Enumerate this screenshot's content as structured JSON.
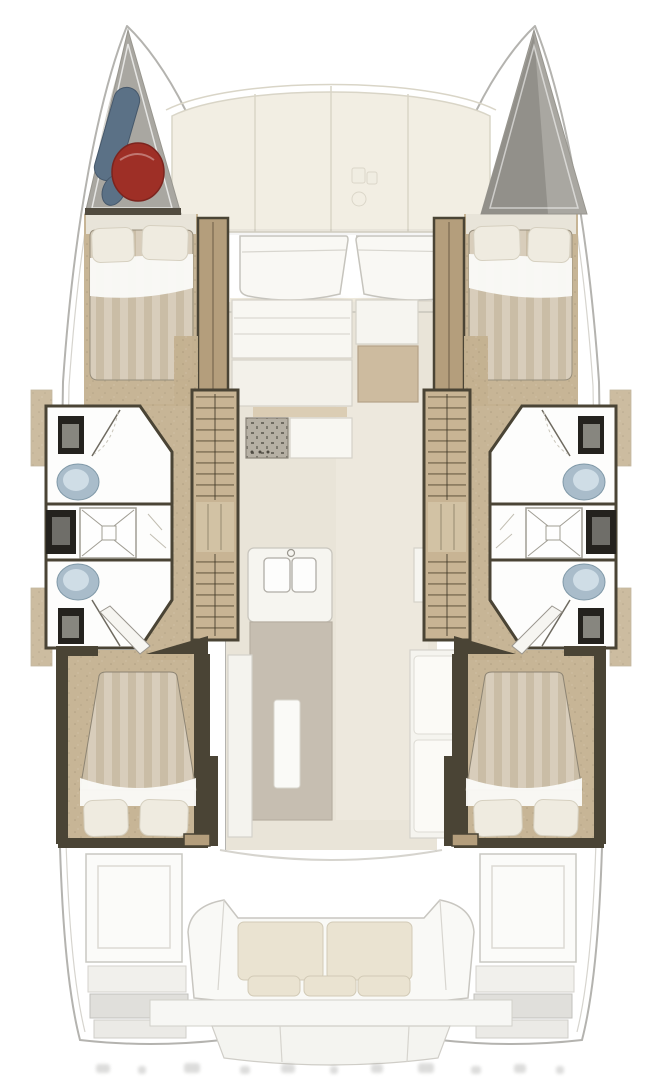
{
  "meta": {
    "title": "Catamaran interior layout floor plan, top-down view",
    "type": "floorplan",
    "view": "top-down"
  },
  "colors": {
    "page_bg": "#ffffff",
    "hull_outline": "#b4b3af",
    "hull_line_soft": "#d6d4ce",
    "deck_cream": "#f2eee3",
    "deck_line": "#d9d5c7",
    "bow_gray": "#a9a7a1",
    "bow_gray_dark": "#8e8c86",
    "fender_blue": "#5b7186",
    "buoy_red": "#9e2f26",
    "wood_floor": "#c4b190",
    "step_wood": "#c8b494",
    "wardrobe": "#b49e7c",
    "wall_dark": "#4a4435",
    "mattress_base": "#d8cdbb",
    "mattress_stripe": "#cabda6",
    "pillow": "#efebe0",
    "sheet": "#fafaf7",
    "bath_white": "#fdfdfc",
    "toilet_blue": "#a9bcca",
    "toilet_lid": "#cfdde6",
    "vanity_black": "#24221e",
    "shower_line": "#a09d93",
    "saloon_floor": "#e9e4d8",
    "counter_white": "#f8f7f2",
    "counter_line": "#d5d2c9",
    "stove_base": "#b6b0a4",
    "island_gray": "#c6beb1",
    "table_runner": "#fafaf7",
    "settee_white": "#f5f4ef",
    "desk_tan": "#cdbb9f",
    "cushion": "#eae3d1",
    "cockpit_white": "#f9f9f6",
    "platform_gray": "#e0dfdb",
    "shadow": "#8f8d86",
    "smudge": "#8e8e8b"
  },
  "areas": {
    "port_hull": [
      "bow-storage-locker",
      "forward-double-cabin",
      "forward-head",
      "shower",
      "aft-head",
      "aft-double-cabin",
      "transom-steps"
    ],
    "starboard_hull": [
      "bow-locker",
      "forward-double-cabin",
      "forward-head",
      "shower",
      "aft-head",
      "aft-double-cabin",
      "transom-steps"
    ],
    "center": [
      "foredeck-panels",
      "forward-cockpit-seats",
      "saloon-galley",
      "galley-island-sinks",
      "saloon-table",
      "aft-cockpit-bench",
      "transom-platform"
    ]
  },
  "icons": [
    {
      "name": "windlass-icon"
    },
    {
      "name": "fender-icon"
    },
    {
      "name": "mooring-buoy-icon"
    }
  ]
}
